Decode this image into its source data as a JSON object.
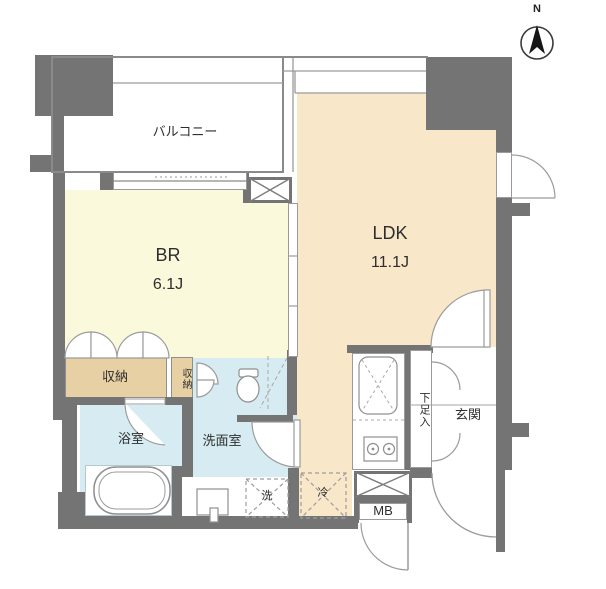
{
  "title": "apartment-floor-plan",
  "compass": {
    "north_label": "N"
  },
  "rooms": {
    "balcony": {
      "label": "バルコニー"
    },
    "bedroom": {
      "label": "BR",
      "size": "6.1J"
    },
    "ldk": {
      "label": "LDK",
      "size": "11.1J"
    },
    "closet_main": {
      "label": "収納"
    },
    "closet_small": {
      "label": "収納"
    },
    "bathroom": {
      "label": "浴室"
    },
    "washroom": {
      "label": "洗面室"
    },
    "entrance": {
      "label": "玄関"
    },
    "shoe_cabinet": {
      "label": "下足入"
    }
  },
  "fixtures": {
    "washer": {
      "label": "洗"
    },
    "fridge": {
      "label": "冷"
    },
    "meter_box": {
      "label": "MB"
    }
  },
  "colors": {
    "wall": "#747474",
    "bedroom_floor": "#fbf9dc",
    "ldk_floor": "#f9e7c9",
    "closet": "#e7d0a4",
    "wet_area": "#d6ecf2",
    "line": "#8a8a8a"
  }
}
